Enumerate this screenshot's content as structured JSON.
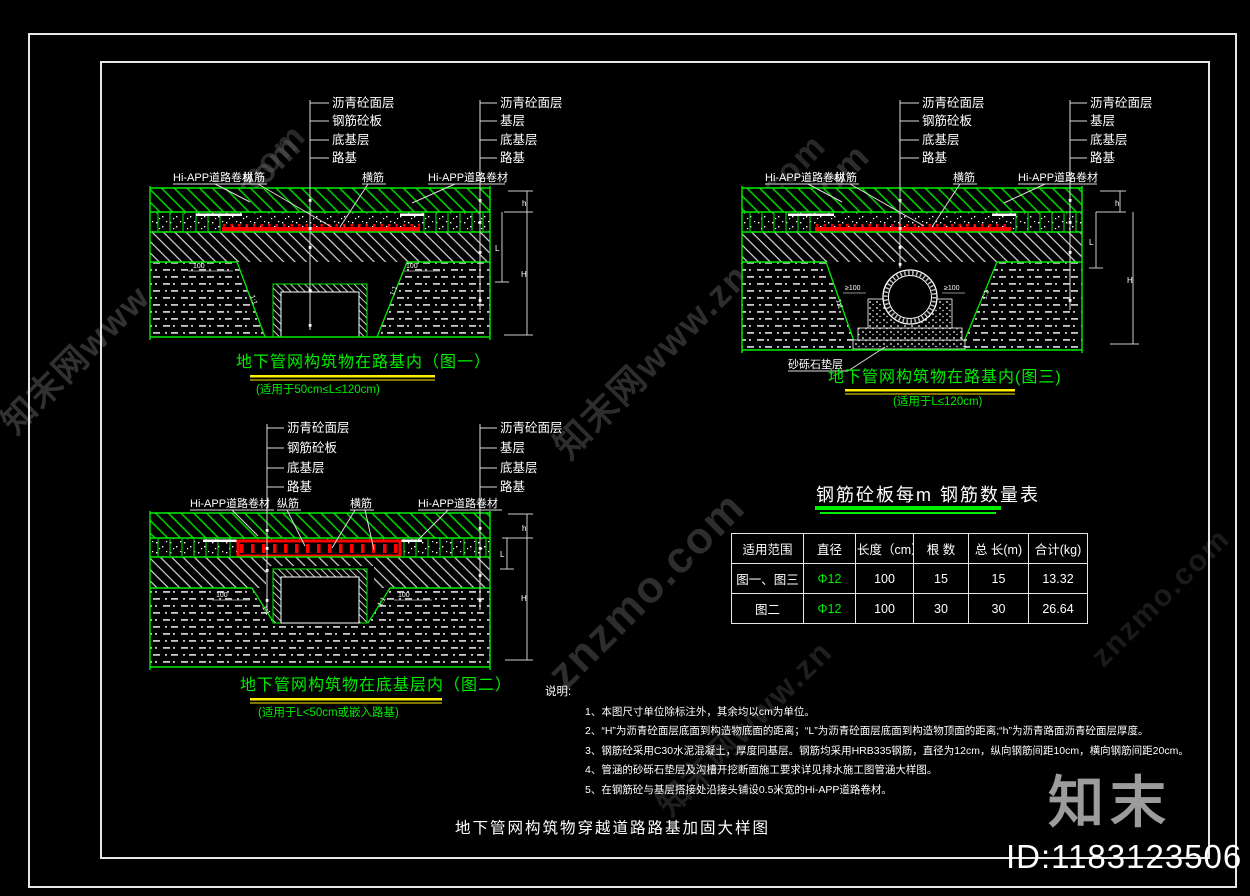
{
  "figures": {
    "common": {
      "layers_left": [
        "沥青砼面层",
        "钢筋砼板",
        "底基层",
        "路基"
      ],
      "layers_right": [
        "沥青砼面层",
        "基层",
        "底基层",
        "路基"
      ],
      "membrane_label": "Hi-APP道路卷材",
      "longitudinal_bar": "纵筋",
      "transverse_bar": "横筋",
      "slope_label": "1:1",
      "dim_100": "100",
      "dim_h": "h",
      "dim_L": "L",
      "dim_H": "H"
    },
    "fig1": {
      "title": "地下管网构筑物在路基内（图一）",
      "subtitle": "(适用于50cm≤L≤120cm)"
    },
    "fig2": {
      "title": "地下管网构筑物在底基层内（图二）",
      "subtitle": "(适用于L<50cm或嵌入路基)"
    },
    "fig3": {
      "title": "地下管网构筑物在路基内(图三)",
      "subtitle": "(适用于L≤120cm)",
      "bedding_label": "砂砾石垫层",
      "dim_ge100": "≥100"
    }
  },
  "table": {
    "title": "钢筋砼板每m 钢筋数量表",
    "headers": [
      "适用范围",
      "直径",
      "长度（cm）",
      "根 数",
      "总 长(m)",
      "合计(kg)"
    ],
    "rows": [
      {
        "range": "图一、图三",
        "dia": "Φ12",
        "len": "100",
        "count": "15",
        "total": "15",
        "weight": "13.32"
      },
      {
        "range": "图二",
        "dia": "Φ12",
        "len": "100",
        "count": "30",
        "total": "30",
        "weight": "26.64"
      }
    ]
  },
  "notes": {
    "heading": "说明:",
    "items": [
      "1、本图尺寸单位除标注外，其余均以cm为单位。",
      "2、“H”为沥青砼面层底面到构造物底面的距离；“L”为沥青砼面层底面到构造物顶面的距离;“h”为沥青路面沥青砼面层厚度。",
      "3、钢筋砼采用C30水泥混凝土，厚度同基层。钢筋均采用HRB335钢筋，直径为12cm，纵向钢筋间距10cm，横向钢筋间距20cm。",
      "4、管涵的砂砾石垫层及沟槽开挖断面施工要求详见排水施工图管涵大样图。",
      "5、在钢筋砼与基层搭接处沿接头铺设0.5米宽的Hi-APP道路卷材。"
    ]
  },
  "caption": "地下管网构筑物穿越道路路基加固大样图",
  "watermark": {
    "site_cn": "知末网www.znzmo.com",
    "site": "znzmo.com",
    "fragment_com": ".com",
    "fragment_partial": "知末网www.zn",
    "logo": "知末",
    "id_label": "ID:1183123506"
  }
}
